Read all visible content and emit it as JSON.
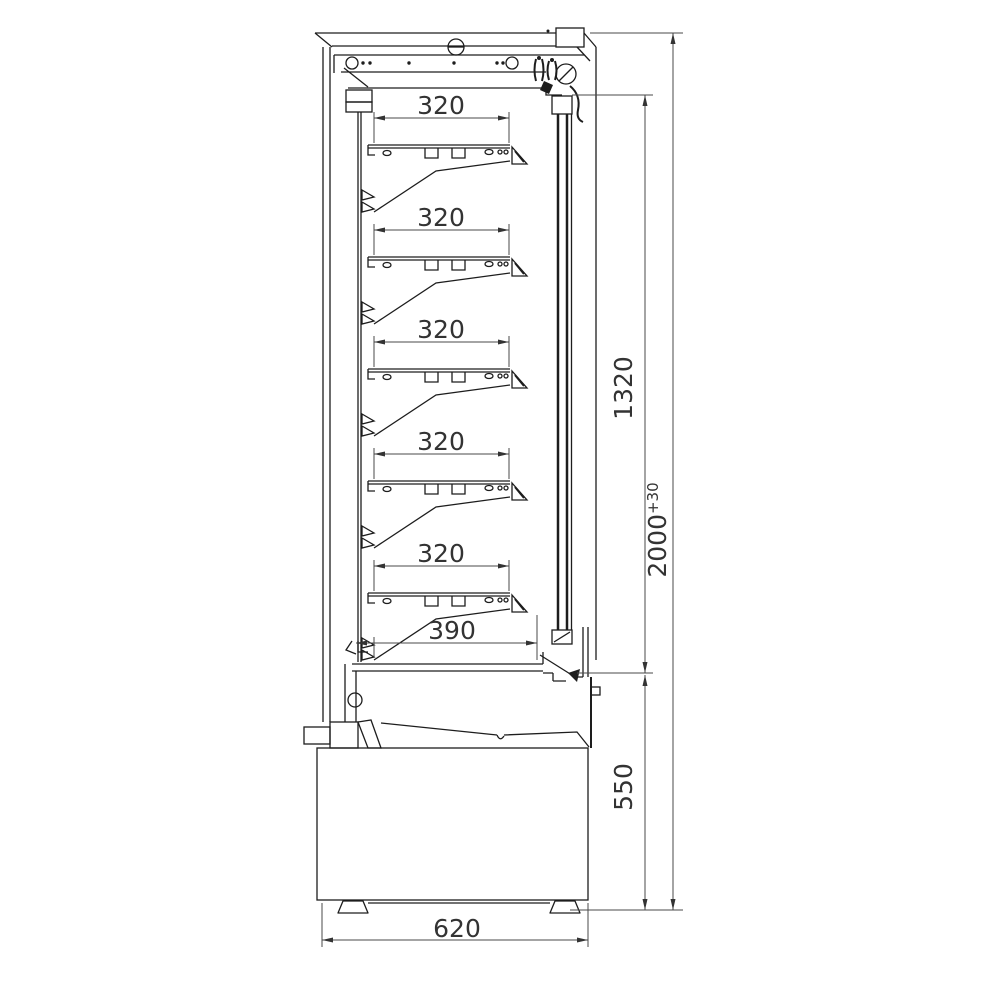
{
  "drawing": {
    "background": "#ffffff",
    "line_color": "#1d1d1d",
    "dim_line_color": "#4a4a4a",
    "text_color": "#333333",
    "labels": {
      "shelf_dims": [
        "320",
        "320",
        "320",
        "320",
        "320"
      ],
      "bottom_shelf_dim": "390",
      "interior_height": "1320",
      "base_height": "550",
      "total_height": "2000",
      "total_height_tolerance": "+30",
      "depth": "620"
    }
  }
}
